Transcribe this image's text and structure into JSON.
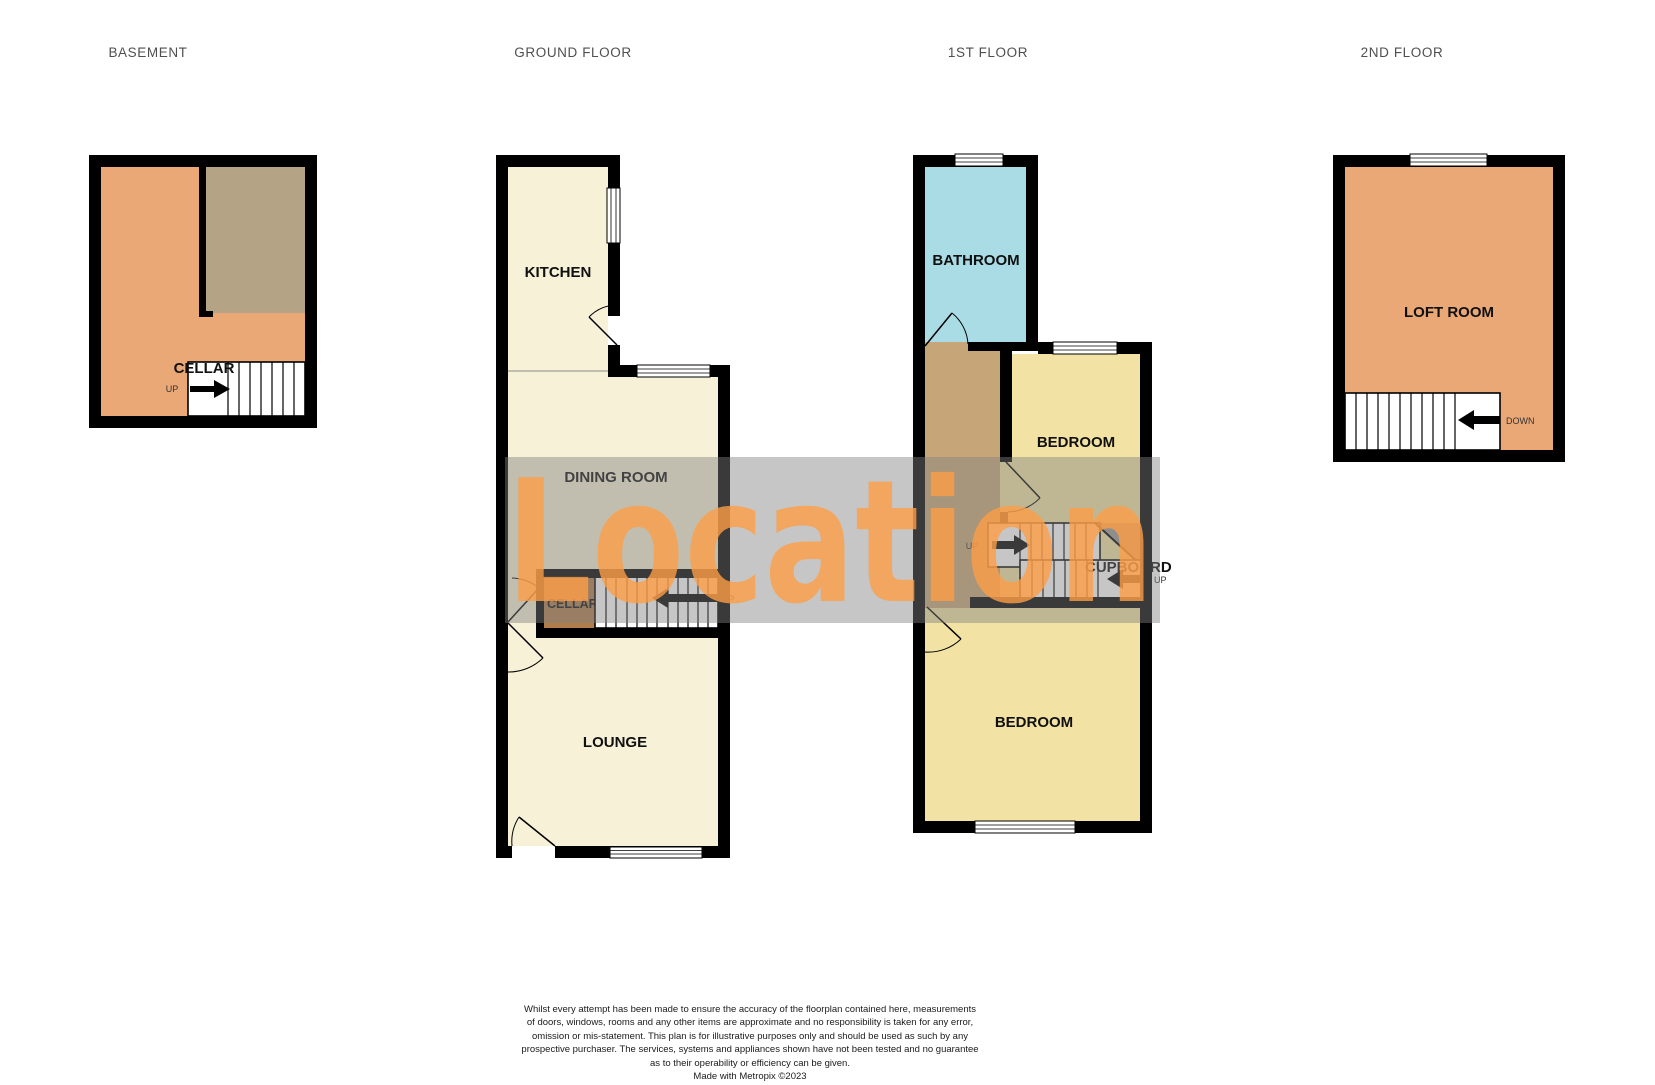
{
  "floors": {
    "basement": {
      "title": "BASEMENT",
      "rooms": {
        "cellar": "CELLAR"
      },
      "stairs": {
        "up": "UP"
      }
    },
    "ground": {
      "title": "GROUND FLOOR",
      "rooms": {
        "kitchen": "KITCHEN",
        "dining_room": "DINING ROOM",
        "cellar": "CELLAR",
        "lounge": "LOUNGE"
      },
      "stairs": {
        "up": "UP"
      }
    },
    "first": {
      "title": "1ST FLOOR",
      "rooms": {
        "bathroom": "BATHROOM",
        "bedroom_rear": "BEDROOM",
        "bedroom_front": "BEDROOM",
        "cupboard": "CUPBOARD"
      },
      "stairs": {
        "up_to_loft": "UP",
        "up_right": "UP"
      }
    },
    "second": {
      "title": "2ND FLOOR",
      "rooms": {
        "loft_room": "LOFT ROOM"
      },
      "stairs": {
        "down": "DOWN"
      }
    }
  },
  "watermark": {
    "text": "Location",
    "band_color": "rgba(128,128,128,0.45)",
    "text_color": "rgba(253,158,70,0.8)"
  },
  "palette": {
    "wall": "#000000",
    "cream": "#f6f1d7",
    "bedroom_yellow": "#f2e3a4",
    "bathroom_blue": "#aadce5",
    "orange": "#e9a876",
    "basement_tan": "#b5a385",
    "landing_tan": "#c6a678",
    "cellar_brown": "#ad7d4e",
    "stair_white": "#ffffff",
    "winder_gray": "#9a9a9a"
  },
  "disclaimer": {
    "line1": "Whilst every attempt has been made to ensure the accuracy of the floorplan contained here, measurements",
    "line2": "of doors, windows, rooms and any other items are approximate and no responsibility is taken for any error,",
    "line3": "omission or mis-statement. This plan is for illustrative purposes only and should be used as such by any",
    "line4": "prospective purchaser. The services, systems and appliances shown have not been tested and no guarantee",
    "line5": "as to their operability or efficiency can be given.",
    "credit": "Made with Metropix ©2023"
  }
}
